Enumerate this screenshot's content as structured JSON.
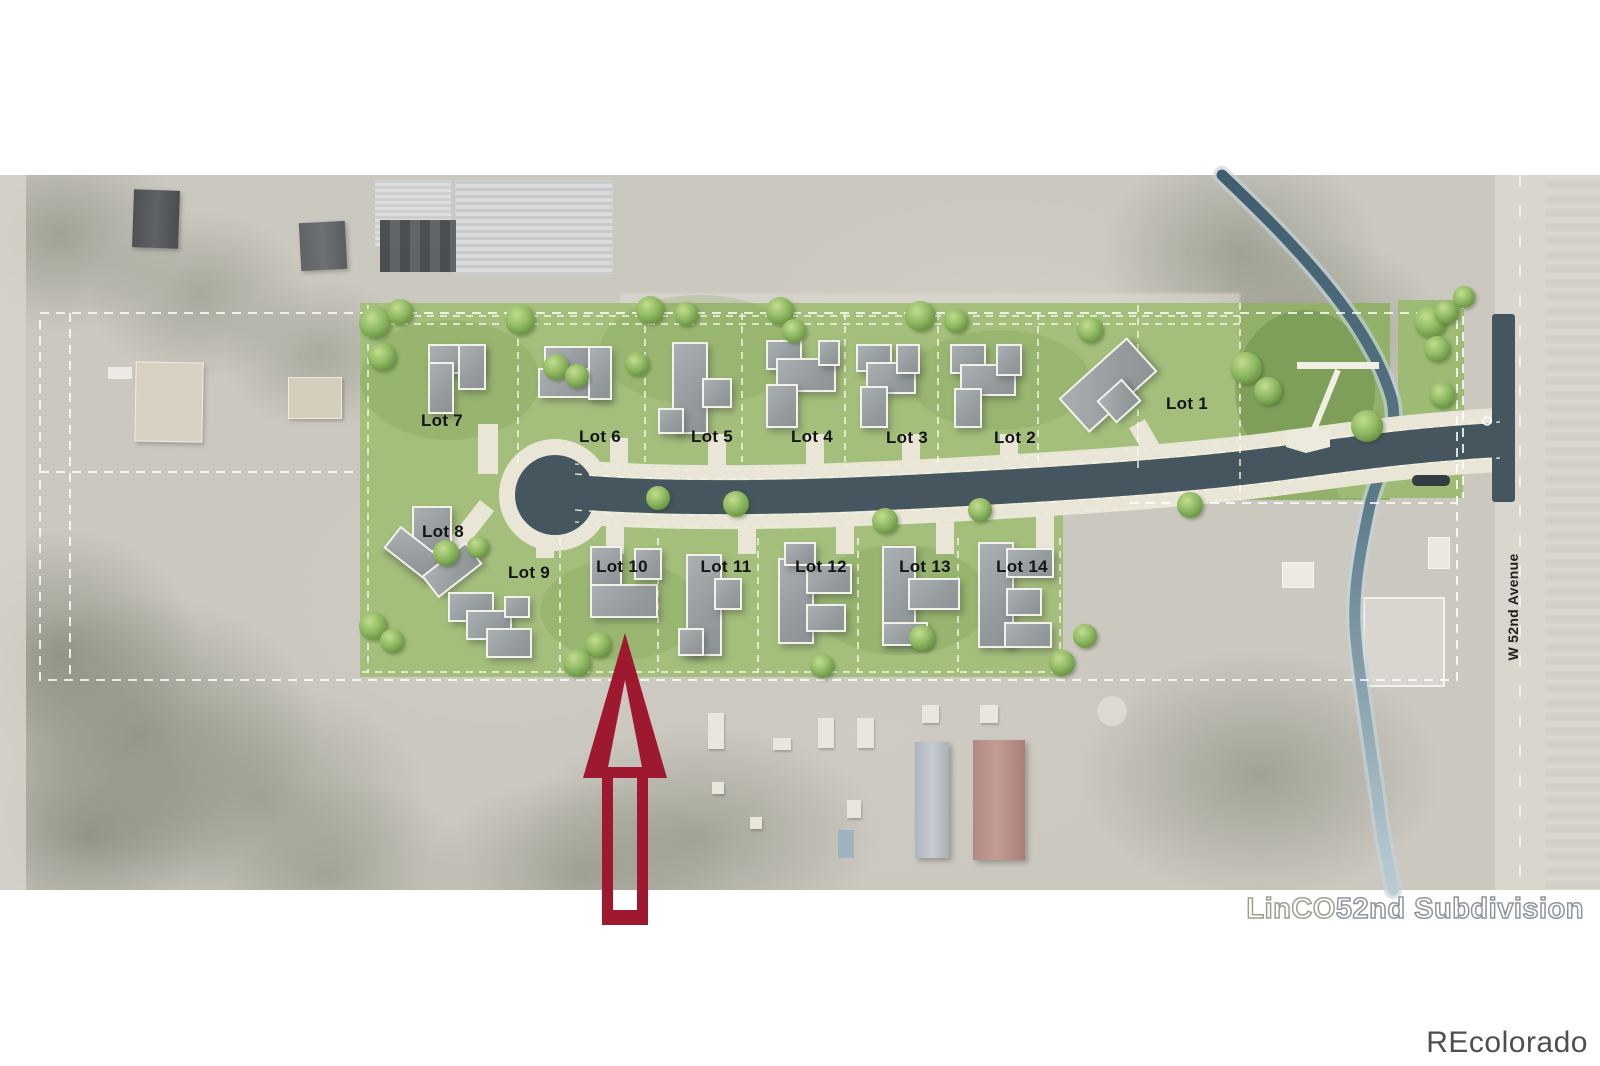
{
  "watermarks": {
    "plan_title_part1": "LinCO",
    "plan_title_part2": "52nd Subdivision",
    "brand": "REcolorado"
  },
  "street": {
    "label": "W 52nd Avenue"
  },
  "site": {
    "arrow": {
      "target": "Lot 10",
      "color": "#9e1830"
    },
    "colors": {
      "grass": "#a4bf7c",
      "grass_dark": "#8fae68",
      "road": "#46565e",
      "sidewalk": "#e9e6d8",
      "creek": "#54707f",
      "boundary_dash": "#ffffff",
      "building": "#9ca1a3",
      "arrow": "#9e1830"
    },
    "lots": [
      {
        "id": "lot-1",
        "label": "Lot 1",
        "x": 1187,
        "y": 404
      },
      {
        "id": "lot-2",
        "label": "Lot 2",
        "x": 1015,
        "y": 438
      },
      {
        "id": "lot-3",
        "label": "Lot 3",
        "x": 907,
        "y": 438
      },
      {
        "id": "lot-4",
        "label": "Lot 4",
        "x": 812,
        "y": 437
      },
      {
        "id": "lot-5",
        "label": "Lot 5",
        "x": 712,
        "y": 437
      },
      {
        "id": "lot-6",
        "label": "Lot 6",
        "x": 600,
        "y": 437
      },
      {
        "id": "lot-7",
        "label": "Lot 7",
        "x": 442,
        "y": 421
      },
      {
        "id": "lot-8",
        "label": "Lot 8",
        "x": 443,
        "y": 532
      },
      {
        "id": "lot-9",
        "label": "Lot 9",
        "x": 529,
        "y": 573
      },
      {
        "id": "lot-10",
        "label": "Lot 10",
        "x": 622,
        "y": 567
      },
      {
        "id": "lot-11",
        "label": "Lot 11",
        "x": 726,
        "y": 567
      },
      {
        "id": "lot-12",
        "label": "Lot 12",
        "x": 821,
        "y": 567
      },
      {
        "id": "lot-13",
        "label": "Lot 13",
        "x": 925,
        "y": 567
      },
      {
        "id": "lot-14",
        "label": "Lot 14",
        "x": 1022,
        "y": 567
      }
    ],
    "buildings": [
      {
        "lot": "Lot 7",
        "rects": [
          [
            428,
            344,
            52,
            26,
            0
          ],
          [
            428,
            362,
            22,
            48,
            0
          ],
          [
            458,
            344,
            24,
            42,
            0
          ]
        ]
      },
      {
        "lot": "Lot 6",
        "rects": [
          [
            544,
            346,
            46,
            26,
            0
          ],
          [
            538,
            368,
            66,
            26,
            0
          ],
          [
            588,
            346,
            20,
            50,
            0
          ]
        ]
      },
      {
        "lot": "Lot 5",
        "rects": [
          [
            672,
            342,
            32,
            88,
            0
          ],
          [
            702,
            378,
            26,
            26,
            0
          ],
          [
            658,
            408,
            22,
            22,
            0
          ]
        ]
      },
      {
        "lot": "Lot 4",
        "rects": [
          [
            766,
            340,
            32,
            26,
            0
          ],
          [
            776,
            358,
            56,
            30,
            0
          ],
          [
            766,
            384,
            28,
            40,
            0
          ],
          [
            818,
            340,
            18,
            22,
            0
          ]
        ]
      },
      {
        "lot": "Lot 3",
        "rects": [
          [
            856,
            344,
            32,
            24,
            0
          ],
          [
            866,
            362,
            46,
            28,
            0
          ],
          [
            860,
            386,
            24,
            38,
            0
          ],
          [
            896,
            344,
            20,
            26,
            0
          ]
        ]
      },
      {
        "lot": "Lot 2",
        "rects": [
          [
            950,
            344,
            32,
            26,
            0
          ],
          [
            960,
            364,
            52,
            28,
            0
          ],
          [
            954,
            388,
            24,
            36,
            0
          ],
          [
            996,
            344,
            22,
            28,
            0
          ]
        ]
      },
      {
        "lot": "Lot 1",
        "rects": [
          [
            1062,
            362,
            88,
            42,
            -42
          ],
          [
            1102,
            386,
            30,
            26,
            -42
          ]
        ]
      },
      {
        "lot": "Lot 8",
        "rects": [
          [
            412,
            506,
            36,
            42,
            0
          ],
          [
            386,
            540,
            52,
            24,
            38
          ],
          [
            424,
            556,
            52,
            24,
            -38
          ]
        ]
      },
      {
        "lot": "Lot 9",
        "rects": [
          [
            448,
            592,
            42,
            26,
            0
          ],
          [
            466,
            610,
            42,
            26,
            0
          ],
          [
            486,
            628,
            42,
            26,
            0
          ],
          [
            504,
            596,
            22,
            18,
            0
          ]
        ]
      },
      {
        "lot": "Lot 10",
        "rects": [
          [
            590,
            546,
            28,
            46,
            0
          ],
          [
            590,
            584,
            64,
            30,
            0
          ],
          [
            634,
            548,
            24,
            28,
            0
          ]
        ]
      },
      {
        "lot": "Lot 11",
        "rects": [
          [
            686,
            554,
            32,
            98,
            0
          ],
          [
            714,
            578,
            24,
            28,
            0
          ],
          [
            678,
            628,
            22,
            24,
            0
          ]
        ]
      },
      {
        "lot": "Lot 12",
        "rects": [
          [
            778,
            558,
            32,
            82,
            0
          ],
          [
            806,
            564,
            42,
            26,
            0
          ],
          [
            806,
            604,
            36,
            24,
            0
          ],
          [
            784,
            542,
            28,
            20,
            0
          ]
        ]
      },
      {
        "lot": "Lot 13",
        "rects": [
          [
            882,
            546,
            30,
            94,
            0
          ],
          [
            908,
            578,
            48,
            28,
            0
          ],
          [
            882,
            622,
            42,
            20,
            0
          ]
        ]
      },
      {
        "lot": "Lot 14",
        "rects": [
          [
            978,
            542,
            32,
            102,
            0
          ],
          [
            1006,
            548,
            44,
            26,
            0
          ],
          [
            1006,
            588,
            32,
            24,
            0
          ],
          [
            1004,
            622,
            44,
            22,
            0
          ]
        ]
      }
    ],
    "trees": [
      {
        "x": 375,
        "y": 323,
        "r": 16
      },
      {
        "x": 400,
        "y": 312,
        "r": 13
      },
      {
        "x": 382,
        "y": 357,
        "r": 14
      },
      {
        "x": 520,
        "y": 320,
        "r": 15
      },
      {
        "x": 556,
        "y": 367,
        "r": 13
      },
      {
        "x": 577,
        "y": 376,
        "r": 12
      },
      {
        "x": 637,
        "y": 364,
        "r": 12
      },
      {
        "x": 650,
        "y": 310,
        "r": 14
      },
      {
        "x": 686,
        "y": 314,
        "r": 12
      },
      {
        "x": 780,
        "y": 311,
        "r": 14
      },
      {
        "x": 794,
        "y": 331,
        "r": 12
      },
      {
        "x": 920,
        "y": 316,
        "r": 15
      },
      {
        "x": 956,
        "y": 321,
        "r": 12
      },
      {
        "x": 1090,
        "y": 330,
        "r": 13
      },
      {
        "x": 1246,
        "y": 368,
        "r": 16
      },
      {
        "x": 1268,
        "y": 391,
        "r": 14
      },
      {
        "x": 1190,
        "y": 505,
        "r": 13
      },
      {
        "x": 1367,
        "y": 426,
        "r": 16
      },
      {
        "x": 1430,
        "y": 322,
        "r": 16
      },
      {
        "x": 1446,
        "y": 312,
        "r": 12
      },
      {
        "x": 1437,
        "y": 349,
        "r": 13
      },
      {
        "x": 1442,
        "y": 395,
        "r": 13
      },
      {
        "x": 1464,
        "y": 297,
        "r": 11
      },
      {
        "x": 373,
        "y": 626,
        "r": 14
      },
      {
        "x": 392,
        "y": 641,
        "r": 12
      },
      {
        "x": 446,
        "y": 553,
        "r": 13
      },
      {
        "x": 478,
        "y": 547,
        "r": 11
      },
      {
        "x": 598,
        "y": 645,
        "r": 13
      },
      {
        "x": 577,
        "y": 663,
        "r": 14
      },
      {
        "x": 658,
        "y": 498,
        "r": 12
      },
      {
        "x": 736,
        "y": 504,
        "r": 13
      },
      {
        "x": 885,
        "y": 521,
        "r": 13
      },
      {
        "x": 922,
        "y": 638,
        "r": 13
      },
      {
        "x": 822,
        "y": 666,
        "r": 12
      },
      {
        "x": 980,
        "y": 510,
        "r": 12
      },
      {
        "x": 1062,
        "y": 663,
        "r": 13
      },
      {
        "x": 1085,
        "y": 636,
        "r": 12
      }
    ]
  }
}
